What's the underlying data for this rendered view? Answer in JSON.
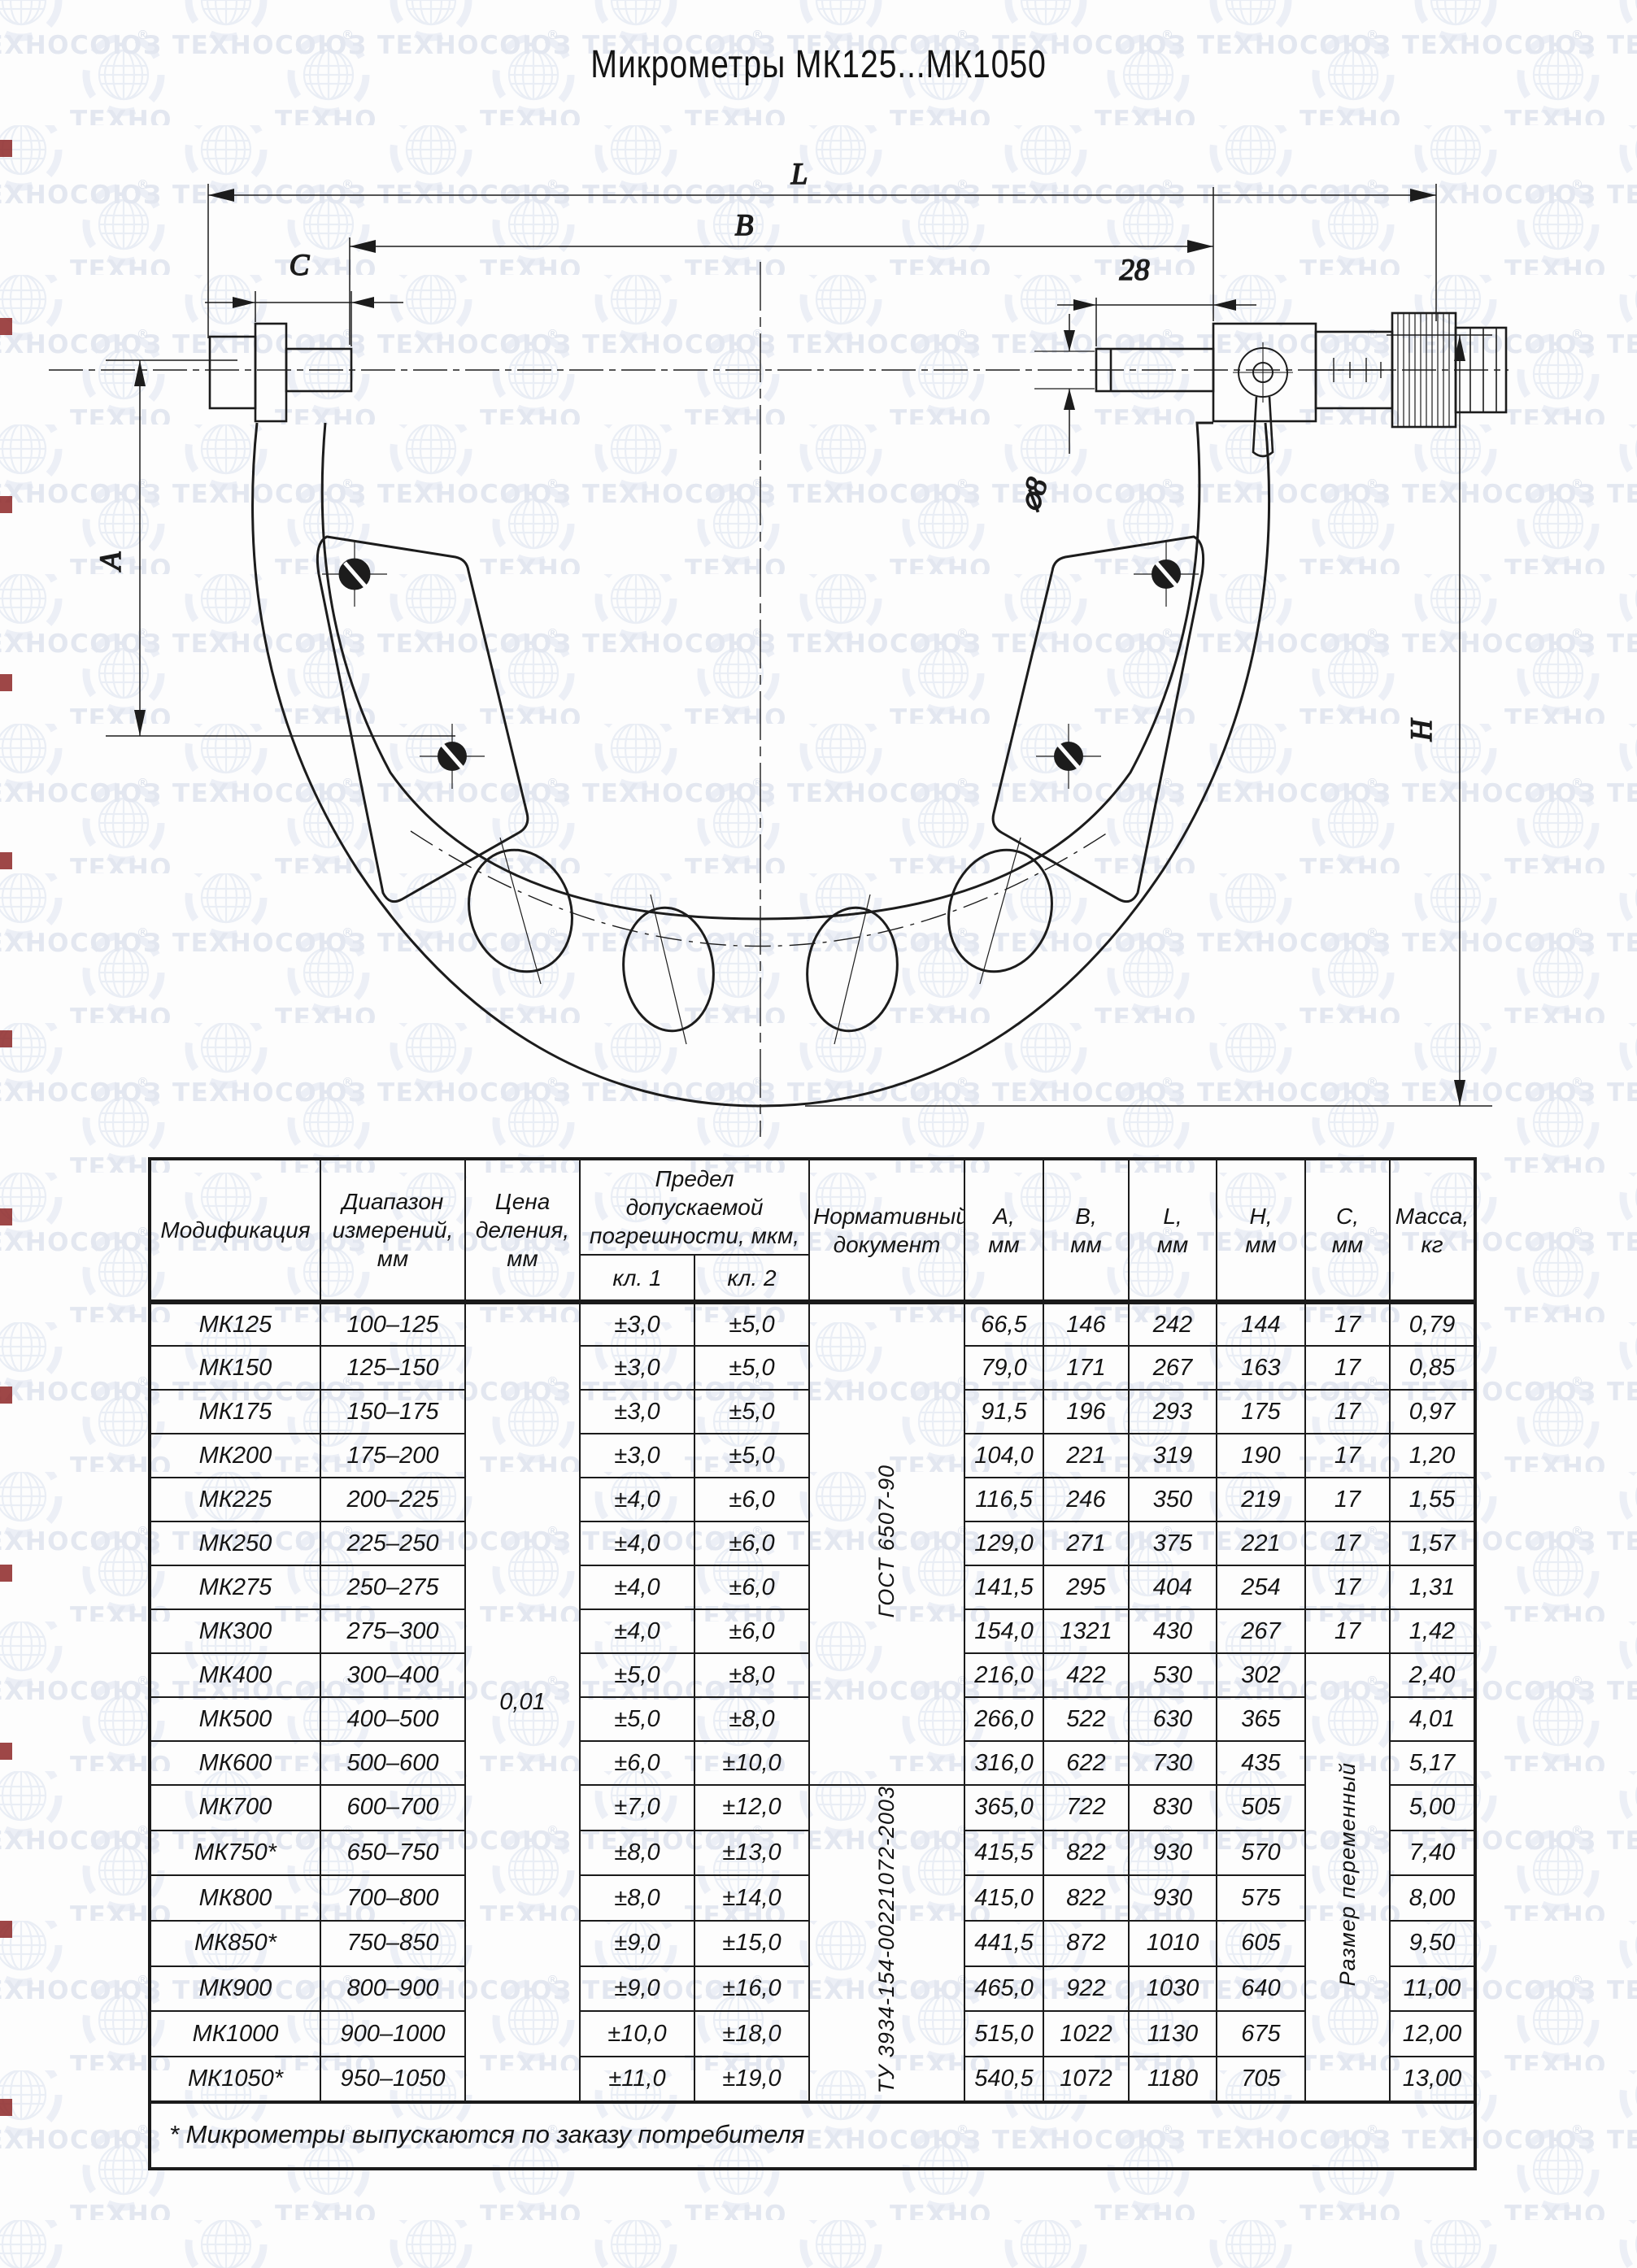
{
  "title": "Микрометры МК125...МК1050",
  "watermark": {
    "text": "ТЕХНОСОЮЗ",
    "reg": "®"
  },
  "drawing": {
    "labels": {
      "L": "L",
      "B": "B",
      "C": "C",
      "dim28": "28",
      "dia8": "⌀8",
      "A": "A",
      "H": "Н"
    }
  },
  "table": {
    "headers": {
      "modification": "Модификация",
      "range": "Диапазон\nизмерений,\nмм",
      "division": "Цена\nделения,\nмм",
      "error_limit": "Предел допускаемой\nпогрешности, мкм,",
      "cl1": "кл. 1",
      "cl2": "кл. 2",
      "norm_doc": "Нормативный\nдокумент",
      "a": "А,\nмм",
      "b": "В,\nмм",
      "l": "L,\nмм",
      "h": "Н,\nмм",
      "c": "С,\nмм",
      "mass": "Масса,\nкг"
    },
    "price_division": "0,01",
    "norm_docs": [
      {
        "text": "ГОСТ 6507-90",
        "start": 0,
        "span": 11
      },
      {
        "text": "ТУ 3934-154-00221072-2003",
        "start": 11,
        "span": 7
      }
    ],
    "c_variable": {
      "text": "Размер переменный",
      "start": 8,
      "span": 10
    },
    "rows": [
      {
        "mod": "МК125",
        "range": "100–125",
        "cl1": "±3,0",
        "cl2": "±5,0",
        "a": "66,5",
        "b": "146",
        "l": "242",
        "h": "144",
        "c": "17",
        "mass": "0,79"
      },
      {
        "mod": "МК150",
        "range": "125–150",
        "cl1": "±3,0",
        "cl2": "±5,0",
        "a": "79,0",
        "b": "171",
        "l": "267",
        "h": "163",
        "c": "17",
        "mass": "0,85"
      },
      {
        "mod": "МК175",
        "range": "150–175",
        "cl1": "±3,0",
        "cl2": "±5,0",
        "a": "91,5",
        "b": "196",
        "l": "293",
        "h": "175",
        "c": "17",
        "mass": "0,97"
      },
      {
        "mod": "МК200",
        "range": "175–200",
        "cl1": "±3,0",
        "cl2": "±5,0",
        "a": "104,0",
        "b": "221",
        "l": "319",
        "h": "190",
        "c": "17",
        "mass": "1,20"
      },
      {
        "mod": "МК225",
        "range": "200–225",
        "cl1": "±4,0",
        "cl2": "±6,0",
        "a": "116,5",
        "b": "246",
        "l": "350",
        "h": "219",
        "c": "17",
        "mass": "1,55"
      },
      {
        "mod": "МК250",
        "range": "225–250",
        "cl1": "±4,0",
        "cl2": "±6,0",
        "a": "129,0",
        "b": "271",
        "l": "375",
        "h": "221",
        "c": "17",
        "mass": "1,57"
      },
      {
        "mod": "МК275",
        "range": "250–275",
        "cl1": "±4,0",
        "cl2": "±6,0",
        "a": "141,5",
        "b": "295",
        "l": "404",
        "h": "254",
        "c": "17",
        "mass": "1,31"
      },
      {
        "mod": "МК300",
        "range": "275–300",
        "cl1": "±4,0",
        "cl2": "±6,0",
        "a": "154,0",
        "b": "1321",
        "l": "430",
        "h": "267",
        "c": "17",
        "mass": "1,42"
      },
      {
        "mod": "МК400",
        "range": "300–400",
        "cl1": "±5,0",
        "cl2": "±8,0",
        "a": "216,0",
        "b": "422",
        "l": "530",
        "h": "302",
        "c": "",
        "mass": "2,40"
      },
      {
        "mod": "МК500",
        "range": "400–500",
        "cl1": "±5,0",
        "cl2": "±8,0",
        "a": "266,0",
        "b": "522",
        "l": "630",
        "h": "365",
        "c": "",
        "mass": "4,01"
      },
      {
        "mod": "МК600",
        "range": "500–600",
        "cl1": "±6,0",
        "cl2": "±10,0",
        "a": "316,0",
        "b": "622",
        "l": "730",
        "h": "435",
        "c": "",
        "mass": "5,17"
      },
      {
        "mod": "МК700",
        "range": "600–700",
        "cl1": "±7,0",
        "cl2": "±12,0",
        "a": "365,0",
        "b": "722",
        "l": "830",
        "h": "505",
        "c": "",
        "mass": "5,00"
      },
      {
        "mod": "МК750*",
        "range": "650–750",
        "cl1": "±8,0",
        "cl2": "±13,0",
        "a": "415,5",
        "b": "822",
        "l": "930",
        "h": "570",
        "c": "",
        "mass": "7,40"
      },
      {
        "mod": "МК800",
        "range": "700–800",
        "cl1": "±8,0",
        "cl2": "±14,0",
        "a": "415,0",
        "b": "822",
        "l": "930",
        "h": "575",
        "c": "",
        "mass": "8,00"
      },
      {
        "mod": "МК850*",
        "range": "750–850",
        "cl1": "±9,0",
        "cl2": "±15,0",
        "a": "441,5",
        "b": "872",
        "l": "1010",
        "h": "605",
        "c": "",
        "mass": "9,50"
      },
      {
        "mod": "МК900",
        "range": "800–900",
        "cl1": "±9,0",
        "cl2": "±16,0",
        "a": "465,0",
        "b": "922",
        "l": "1030",
        "h": "640",
        "c": "",
        "mass": "11,00"
      },
      {
        "mod": "МК1000",
        "range": "900–1000",
        "cl1": "±10,0",
        "cl2": "±18,0",
        "a": "515,0",
        "b": "1022",
        "l": "1130",
        "h": "675",
        "c": "",
        "mass": "12,00"
      },
      {
        "mod": "МК1050*",
        "range": "950–1050",
        "cl1": "±11,0",
        "cl2": "±19,0",
        "a": "540,5",
        "b": "1072",
        "l": "1180",
        "h": "705",
        "c": "",
        "mass": "13,00"
      }
    ],
    "footnote": "* Микрометры выпускаются по заказу потребителя"
  }
}
